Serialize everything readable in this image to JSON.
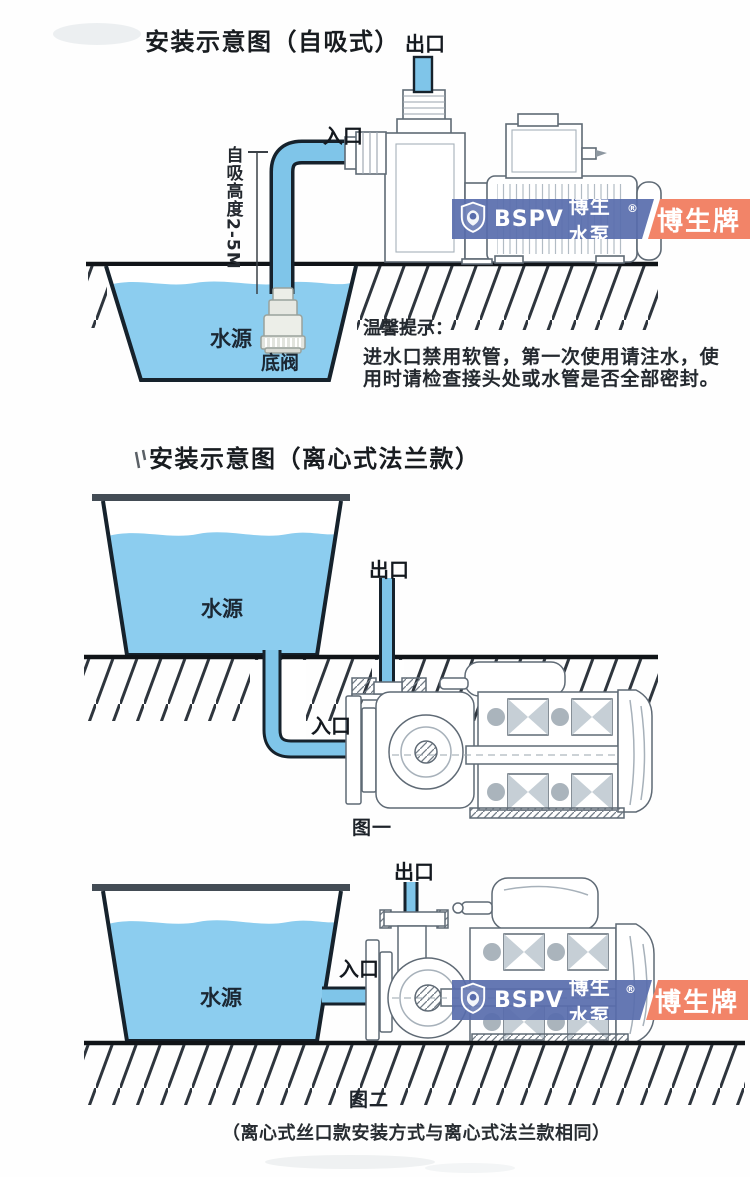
{
  "colors": {
    "water_blue": "#8ccdef",
    "pipe_blue": "#7fc5e9",
    "line_dark": "#16222c",
    "pump_line_gray": "#5f6a75",
    "watermark_blue": "#586cac",
    "watermark_orange": "#f28468",
    "text_dark": "#1d232a"
  },
  "watermark": {
    "logo_icon": "bspv-shield-icon",
    "brand_en": "BSPV",
    "brand_cn": "博生水泵",
    "registered": "®",
    "badge": "博生牌"
  },
  "self_priming": {
    "title": "安装示意图（自吸式）",
    "outlet": "出口",
    "inlet": "入口",
    "suction_height": "自吸高度2-5M",
    "water_source": "水源",
    "foot_valve": "底阀",
    "tips_heading": "温馨提示：",
    "tips_line1": "进水口禁用软管，第一次使用请注水，使",
    "tips_line2": "用时请检查接头处或水管是否全部密封。"
  },
  "centrifugal": {
    "title": "安装示意图（离心式法兰款）",
    "fig1": {
      "outlet": "出口",
      "inlet": "入口",
      "water_source": "水源",
      "caption": "图一"
    },
    "fig2": {
      "outlet": "出口",
      "inlet": "入口",
      "water_source": "水源",
      "caption": "图二"
    },
    "footnote": "（离心式丝口款安装方式与离心式法兰款相同）"
  }
}
